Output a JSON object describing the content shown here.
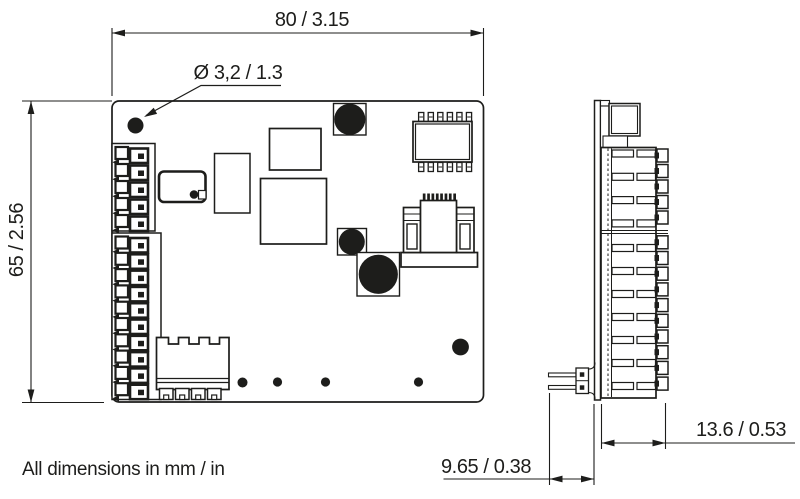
{
  "drawing": {
    "type": "technical dimensional drawing",
    "subject": "printed circuit board, front view and side view",
    "front_view": {
      "width_dim": "80 / 3.15",
      "height_dim": "65 / 2.56",
      "hole_dim": "Ø 3,2 / 1.3"
    },
    "side_view": {
      "depth_dim": "13.6 / 0.53",
      "pin_dim": "9.65 / 0.38"
    },
    "note": "All dimensions in mm / in",
    "colors": {
      "line": "#1d1d1b",
      "background": "#ffffff"
    }
  }
}
